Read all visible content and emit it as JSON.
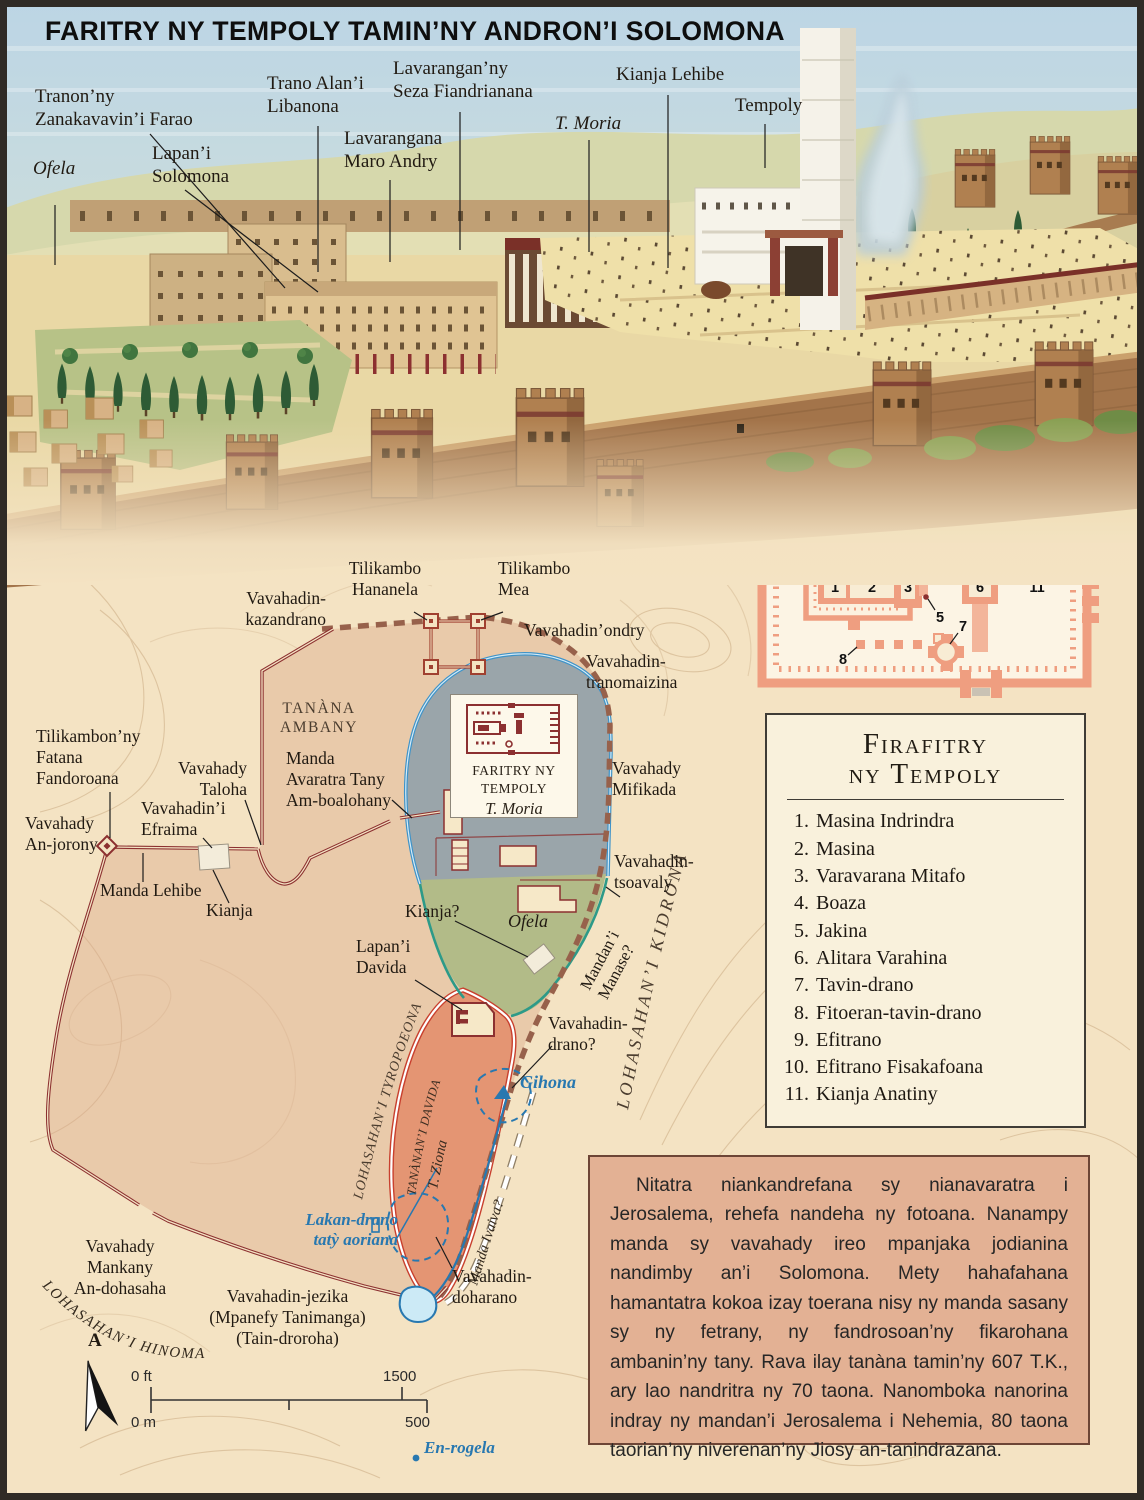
{
  "title": "FARITRY NY TEMPOLY TAMIN’NY ANDRON’I SOLOMONA",
  "palette": {
    "paper": "#f4e3c3",
    "contour": "#d7bc97",
    "wall_red": "#8c3030",
    "dashed_wall_brown": "#97614b",
    "temple_mount_gray": "#9aa5aa",
    "mount_outline_blue": "#3f93c8",
    "ofela_green": "#b2bb88",
    "city_of_david_salmon": "#e49573",
    "water_blue": "#2878b0",
    "city_tint_pink": "#dcab8c",
    "legend_bg": "#f9f1dc",
    "infobox_bg": "#e3b194",
    "plan_wall_salmon": "#ef9e80",
    "plan_floor": "#fcf4e4"
  },
  "illustration": {
    "labels": {
      "farao": "Tranon’ny\nZanakavavin’i Farao",
      "ofela": "Ofela",
      "solomona": "Lapan’i\nSolomona",
      "libanona": "Trano Alan’i\nLibanona",
      "maro_andry": "Lavarangana\nMaro Andry",
      "seza": "Lavarangan’ny\nSeza Fiandrianana",
      "moria": "T. Moria",
      "kianja_lehibe": "Kianja Lehibe",
      "tempoly": "Tempoly"
    }
  },
  "map": {
    "labels": {
      "kazandrano": "Vavahadin-\nkazandrano",
      "hananela": "Tilikambo\nHananela",
      "mea": "Tilikambo\nMea",
      "ondry": "Vavahadin’ondry",
      "tranomaizina": "Vavahadin-\ntranomaizina",
      "tanana_ambany": "TANÀNA\nAMBANY",
      "manda_avaratra": "Manda\nAvaratra Tany\nAm-boalohany",
      "fandoroana": "Tilikambon’ny\nFatana\nFandoroana",
      "anjorony": "Vavahady\nAn-jorony",
      "efraima": "Vavahadin’i\nEfraima",
      "taloha": "Vavahady\nTaloha",
      "manda_lehibe": "Manda Lehibe",
      "kianja": "Kianja",
      "mifikada": "Vavahady\nMifikada",
      "tsoavaly": "Vavahadin-\ntsoavaly",
      "kianja_q": "Kianja?",
      "ofela": "Ofela",
      "lapani_davida": "Lapan’i\nDavida",
      "manase": "Mandan’i\nManase?",
      "drano": "Vavahadin-\ndrano?",
      "gihona": "Gihona",
      "lakan_drano": "Lakan-drano\ntatỳ aoriana",
      "mankany": "Vavahady\nMankany\nAn-dohasaha",
      "jezika": "Vavahadin-jezika\n(Mpanefy Tanimanga)\n(Tain-droroha)",
      "doharano": "Vavahadin-\ndoharano",
      "en_rogela": "En-rogela",
      "tyropoeona": "LOHASAHAN’I TYROPOEONA",
      "kidrona": "LOHASAHAN’I KIDRONA",
      "hinoma": "LOHASAHAN’I HINOMA",
      "tananani_davida": "TANÀNAN’I DAVIDA",
      "tziona": "T. Ziona",
      "manda_ivaiva": "Manda Ivaiva?"
    },
    "temple_box": {
      "line1": "FARITRY NY\nTEMPOLY",
      "line2": "T. Moria"
    },
    "compass_north": "A",
    "scale": {
      "ft_start": "0 ft",
      "ft_end": "1500",
      "m_start": "0 m",
      "m_end": "500"
    }
  },
  "floor_plan": {
    "numbers": [
      "1",
      "2",
      "3",
      "4",
      "5",
      "6",
      "7",
      "8",
      "9",
      "10",
      "11"
    ]
  },
  "legend": {
    "title_line1": "Firafitry",
    "title_line2": "ny Tempoly",
    "items": [
      {
        "n": "1.",
        "label": "Masina Indrindra"
      },
      {
        "n": "2.",
        "label": "Masina"
      },
      {
        "n": "3.",
        "label": "Varavarana Mitafo"
      },
      {
        "n": "4.",
        "label": "Boaza"
      },
      {
        "n": "5.",
        "label": "Jakina"
      },
      {
        "n": "6.",
        "label": "Alitara Varahina"
      },
      {
        "n": "7.",
        "label": "Tavin-drano"
      },
      {
        "n": "8.",
        "label": "Fitoeran-tavin-drano"
      },
      {
        "n": "9.",
        "label": "Efitrano"
      },
      {
        "n": "10.",
        "label": "Efitrano Fisakafoana"
      },
      {
        "n": "11.",
        "label": "Kianja Anatiny"
      }
    ]
  },
  "info": {
    "text": "Nitatra niankandrefana sy nianavaratra i Jerosalema, rehefa nandeha ny fotoana. Nanampy manda sy vavahady ireo mpanjaka jodianina nandimby an’i Solomona. Mety hahafahana hamantatra kokoa izay toerana nisy ny manda sasany sy ny fetrany, ny fandrosoan’ny fikarohana ambanin’ny tany. Rava ilay tanàna tamin’ny 607 T.K., ary lao nandritra ny 70 taona. Nanomboka nanorina indray ny mandan’i Jerosalema i Nehemia, 80 taona taorian’ny niverenan’ny Jiosy an-tanindrazana."
  }
}
